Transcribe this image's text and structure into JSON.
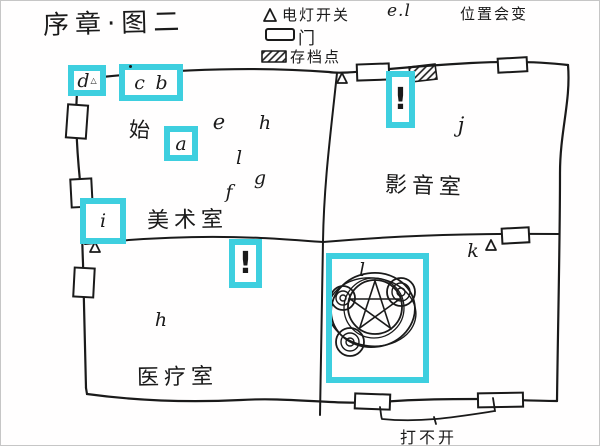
{
  "title": "序章·图二",
  "legend": {
    "items": [
      {
        "symbol": "triangle",
        "label": "电灯开关"
      },
      {
        "symbol": "e.l",
        "label": "位置会变"
      },
      {
        "symbol": "door-rect",
        "label": "门"
      },
      {
        "symbol": "hatched-rect",
        "label": "存档点"
      }
    ],
    "el_symbol": "e.l"
  },
  "rooms": {
    "art": "美术室",
    "av": "影音室",
    "medical": "医疗室"
  },
  "annotations": {
    "start": "始",
    "locked_door": "打不开"
  },
  "markers": {
    "a": "a",
    "b": "b",
    "c": "c",
    "d": "d",
    "e": "e",
    "f": "f",
    "g": "g",
    "h_top": "h",
    "i": "i",
    "j": "j",
    "k": "k",
    "l_top": "l",
    "h_medical": "h",
    "l_ritual": "l",
    "alert_art": "!",
    "alert_av": "!"
  },
  "icons": {
    "light_switch_triangle": "△"
  },
  "colors": {
    "highlight": "#3ecfdf",
    "ink": "#1a1a1a",
    "background": "#ffffff"
  }
}
